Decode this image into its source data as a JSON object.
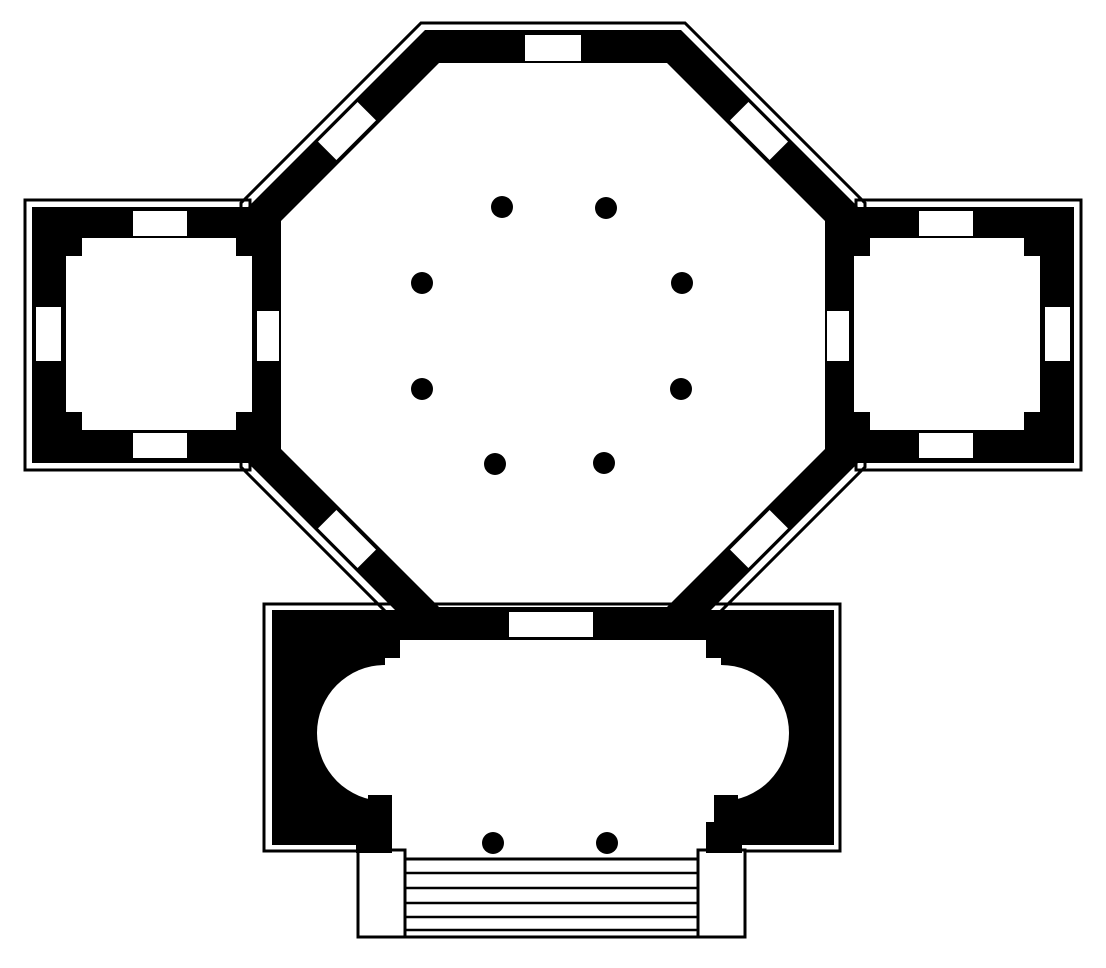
{
  "figure": {
    "kind": "architectural-floor-plan",
    "description": "Black-ink floor plan of an octagonal domed hall with an inner ring of eight columns, flanked by two square side chambers with wall niches, and a south vestibule containing an oval hall with apses at both ends, opening through two porch columns onto a flight of steps.",
    "inventory": {
      "rotunda_columns": 8,
      "porch_columns": 2,
      "step_treads": 6,
      "side_chambers": 2,
      "octagon_windows": 5,
      "chamber_niches_per_chamber": 3,
      "apses": 2
    }
  },
  "colors": {
    "ink": "#000000",
    "paper": "#ffffff",
    "none": "none"
  },
  "canvas": {
    "width": 1106,
    "height": 968
  },
  "shapes": [
    {
      "name": "octagon-outer-outline",
      "type": "polygon",
      "paint": {
        "fill": "none",
        "stroke": "ink",
        "sw": 3
      },
      "attrs": {
        "points": "421,23 685,23 865,203 865,467 685,647 421,647 241,467 241,203"
      }
    },
    {
      "name": "left-chamber-outline",
      "type": "rect",
      "paint": {
        "fill": "none",
        "stroke": "ink",
        "sw": 3
      },
      "attrs": {
        "x": 25,
        "y": 200,
        "width": 225,
        "height": 270
      }
    },
    {
      "name": "right-chamber-outline",
      "type": "rect",
      "paint": {
        "fill": "none",
        "stroke": "ink",
        "sw": 3
      },
      "attrs": {
        "x": 856,
        "y": 200,
        "width": 225,
        "height": 270
      }
    },
    {
      "name": "vestibule-outline",
      "type": "path",
      "paint": {
        "fill": "none",
        "stroke": "ink",
        "sw": 3
      },
      "attrs": {
        "d": "M 361 851 H 264 V 604 H 840 V 851 H 745"
      }
    },
    {
      "name": "octagon-wall-ring",
      "type": "path",
      "paint": {
        "fill": "ink",
        "stroke": "none",
        "sw": 0,
        "evenodd": true
      },
      "attrs": {
        "d": "M425,30 L681,30 L858,207 L858,463 L681,640 L425,640 L248,463 L248,207 Z M439,63 L667,63 L825,221 L825,449 L667,607 L439,607 L281,449 L281,221 Z"
      }
    },
    {
      "name": "left-chamber-walls",
      "type": "rect",
      "paint": {
        "fill": "ink",
        "stroke": "none",
        "sw": 0
      },
      "attrs": {
        "x": 32,
        "y": 207,
        "width": 249,
        "height": 256
      }
    },
    {
      "name": "right-chamber-walls",
      "type": "rect",
      "paint": {
        "fill": "ink",
        "stroke": "none",
        "sw": 0
      },
      "attrs": {
        "x": 825,
        "y": 207,
        "width": 249,
        "height": 256
      }
    },
    {
      "name": "vestibule-walls",
      "type": "rect",
      "paint": {
        "fill": "ink",
        "stroke": "none",
        "sw": 0
      },
      "attrs": {
        "x": 272,
        "y": 610,
        "width": 562,
        "height": 235
      }
    },
    {
      "name": "left-chamber-room",
      "type": "rect",
      "paint": {
        "fill": "paper",
        "stroke": "none",
        "sw": 0
      },
      "attrs": {
        "x": 66,
        "y": 238,
        "width": 186,
        "height": 192
      }
    },
    {
      "name": "right-chamber-room",
      "type": "rect",
      "paint": {
        "fill": "paper",
        "stroke": "none",
        "sw": 0
      },
      "attrs": {
        "x": 854,
        "y": 238,
        "width": 186,
        "height": 192
      }
    },
    {
      "name": "vestibule-hall-center",
      "type": "rect",
      "paint": {
        "fill": "paper",
        "stroke": "none",
        "sw": 0
      },
      "attrs": {
        "x": 385,
        "y": 658,
        "width": 336,
        "height": 187
      }
    },
    {
      "name": "vestibule-hall-top",
      "type": "rect",
      "paint": {
        "fill": "paper",
        "stroke": "none",
        "sw": 0
      },
      "attrs": {
        "x": 400,
        "y": 640,
        "width": 306,
        "height": 20
      }
    },
    {
      "name": "left-apse",
      "type": "circle",
      "paint": {
        "fill": "paper",
        "stroke": "none",
        "sw": 0
      },
      "attrs": {
        "cx": 385,
        "cy": 733,
        "r": 68
      }
    },
    {
      "name": "right-apse",
      "type": "circle",
      "paint": {
        "fill": "paper",
        "stroke": "none",
        "sw": 0
      },
      "attrs": {
        "cx": 721,
        "cy": 733,
        "r": 68
      }
    },
    {
      "name": "left-chamber-corner-pier-nw",
      "type": "rect",
      "paint": {
        "fill": "ink",
        "stroke": "none",
        "sw": 0
      },
      "attrs": {
        "x": 66,
        "y": 238,
        "width": 16,
        "height": 18
      }
    },
    {
      "name": "left-chamber-corner-pier-ne",
      "type": "rect",
      "paint": {
        "fill": "ink",
        "stroke": "none",
        "sw": 0
      },
      "attrs": {
        "x": 236,
        "y": 238,
        "width": 16,
        "height": 18
      }
    },
    {
      "name": "left-chamber-corner-pier-sw",
      "type": "rect",
      "paint": {
        "fill": "ink",
        "stroke": "none",
        "sw": 0
      },
      "attrs": {
        "x": 66,
        "y": 412,
        "width": 16,
        "height": 18
      }
    },
    {
      "name": "left-chamber-corner-pier-se",
      "type": "rect",
      "paint": {
        "fill": "ink",
        "stroke": "none",
        "sw": 0
      },
      "attrs": {
        "x": 236,
        "y": 412,
        "width": 16,
        "height": 18
      }
    },
    {
      "name": "right-chamber-corner-pier-nw",
      "type": "rect",
      "paint": {
        "fill": "ink",
        "stroke": "none",
        "sw": 0
      },
      "attrs": {
        "x": 854,
        "y": 238,
        "width": 16,
        "height": 18
      }
    },
    {
      "name": "right-chamber-corner-pier-ne",
      "type": "rect",
      "paint": {
        "fill": "ink",
        "stroke": "none",
        "sw": 0
      },
      "attrs": {
        "x": 1024,
        "y": 238,
        "width": 16,
        "height": 18
      }
    },
    {
      "name": "right-chamber-corner-pier-sw",
      "type": "rect",
      "paint": {
        "fill": "ink",
        "stroke": "none",
        "sw": 0
      },
      "attrs": {
        "x": 854,
        "y": 412,
        "width": 16,
        "height": 18
      }
    },
    {
      "name": "right-chamber-corner-pier-se",
      "type": "rect",
      "paint": {
        "fill": "ink",
        "stroke": "none",
        "sw": 0
      },
      "attrs": {
        "x": 1024,
        "y": 412,
        "width": 16,
        "height": 18
      }
    },
    {
      "name": "porch-wall-stub-left-upper",
      "type": "rect",
      "paint": {
        "fill": "ink",
        "stroke": "none",
        "sw": 0
      },
      "attrs": {
        "x": 368,
        "y": 795,
        "width": 24,
        "height": 31
      }
    },
    {
      "name": "porch-wall-stub-left-lower",
      "type": "rect",
      "paint": {
        "fill": "ink",
        "stroke": "none",
        "sw": 0
      },
      "attrs": {
        "x": 356,
        "y": 822,
        "width": 36,
        "height": 31
      }
    },
    {
      "name": "porch-wall-stub-right-upper",
      "type": "rect",
      "paint": {
        "fill": "ink",
        "stroke": "none",
        "sw": 0
      },
      "attrs": {
        "x": 714,
        "y": 795,
        "width": 24,
        "height": 31
      }
    },
    {
      "name": "porch-wall-stub-right-lower",
      "type": "rect",
      "paint": {
        "fill": "ink",
        "stroke": "none",
        "sw": 0
      },
      "attrs": {
        "x": 706,
        "y": 822,
        "width": 36,
        "height": 31
      }
    },
    {
      "name": "octagon-window-north",
      "type": "rect",
      "paint": {
        "fill": "paper",
        "stroke": "none",
        "sw": 0
      },
      "attrs": {
        "x": 525,
        "y": 35,
        "width": 56,
        "height": 26
      }
    },
    {
      "name": "octagon-window-northwest",
      "type": "rect",
      "paint": {
        "fill": "paper",
        "stroke": "none",
        "sw": 0
      },
      "attrs": {
        "x": 319,
        "y": 118,
        "width": 56,
        "height": 26,
        "transform": "rotate(-45 347 131)"
      }
    },
    {
      "name": "octagon-window-northeast",
      "type": "rect",
      "paint": {
        "fill": "paper",
        "stroke": "none",
        "sw": 0
      },
      "attrs": {
        "x": 731,
        "y": 118,
        "width": 56,
        "height": 26,
        "transform": "rotate(45 759 131)"
      }
    },
    {
      "name": "octagon-window-southwest",
      "type": "rect",
      "paint": {
        "fill": "paper",
        "stroke": "none",
        "sw": 0
      },
      "attrs": {
        "x": 319,
        "y": 526,
        "width": 56,
        "height": 26,
        "transform": "rotate(45 347 539)"
      }
    },
    {
      "name": "octagon-window-southeast",
      "type": "rect",
      "paint": {
        "fill": "paper",
        "stroke": "none",
        "sw": 0
      },
      "attrs": {
        "x": 731,
        "y": 526,
        "width": 56,
        "height": 26,
        "transform": "rotate(-45 759 539)"
      }
    },
    {
      "name": "octagon-south-doorway",
      "type": "rect",
      "paint": {
        "fill": "paper",
        "stroke": "none",
        "sw": 0
      },
      "attrs": {
        "x": 509,
        "y": 612,
        "width": 84,
        "height": 25
      }
    },
    {
      "name": "left-chamber-niche-north",
      "type": "rect",
      "paint": {
        "fill": "paper",
        "stroke": "none",
        "sw": 0
      },
      "attrs": {
        "x": 133,
        "y": 211,
        "width": 54,
        "height": 25
      }
    },
    {
      "name": "left-chamber-niche-south",
      "type": "rect",
      "paint": {
        "fill": "paper",
        "stroke": "none",
        "sw": 0
      },
      "attrs": {
        "x": 133,
        "y": 433,
        "width": 54,
        "height": 25
      }
    },
    {
      "name": "left-chamber-niche-west",
      "type": "rect",
      "paint": {
        "fill": "paper",
        "stroke": "none",
        "sw": 0
      },
      "attrs": {
        "x": 36,
        "y": 307,
        "width": 25,
        "height": 54
      }
    },
    {
      "name": "left-chamber-doorway",
      "type": "rect",
      "paint": {
        "fill": "paper",
        "stroke": "none",
        "sw": 0
      },
      "attrs": {
        "x": 257,
        "y": 311,
        "width": 22,
        "height": 50
      }
    },
    {
      "name": "right-chamber-niche-north",
      "type": "rect",
      "paint": {
        "fill": "paper",
        "stroke": "none",
        "sw": 0
      },
      "attrs": {
        "x": 919,
        "y": 211,
        "width": 54,
        "height": 25
      }
    },
    {
      "name": "right-chamber-niche-south",
      "type": "rect",
      "paint": {
        "fill": "paper",
        "stroke": "none",
        "sw": 0
      },
      "attrs": {
        "x": 919,
        "y": 433,
        "width": 54,
        "height": 25
      }
    },
    {
      "name": "right-chamber-niche-east",
      "type": "rect",
      "paint": {
        "fill": "paper",
        "stroke": "none",
        "sw": 0
      },
      "attrs": {
        "x": 1045,
        "y": 307,
        "width": 25,
        "height": 54
      }
    },
    {
      "name": "right-chamber-doorway",
      "type": "rect",
      "paint": {
        "fill": "paper",
        "stroke": "none",
        "sw": 0
      },
      "attrs": {
        "x": 827,
        "y": 311,
        "width": 22,
        "height": 50
      }
    },
    {
      "name": "porch-pier-left",
      "type": "rect",
      "paint": {
        "fill": "none",
        "stroke": "ink",
        "sw": 3
      },
      "attrs": {
        "x": 358,
        "y": 850,
        "width": 47,
        "height": 87
      }
    },
    {
      "name": "porch-pier-right",
      "type": "rect",
      "paint": {
        "fill": "none",
        "stroke": "ink",
        "sw": 3
      },
      "attrs": {
        "x": 698,
        "y": 850,
        "width": 47,
        "height": 87
      }
    },
    {
      "name": "steps-outline",
      "type": "rect",
      "paint": {
        "fill": "paper",
        "stroke": "ink",
        "sw": 3
      },
      "attrs": {
        "x": 405,
        "y": 859,
        "width": 293,
        "height": 78
      }
    },
    {
      "name": "step-line-1",
      "type": "line",
      "paint": {
        "fill": "none",
        "stroke": "ink",
        "sw": 2.5
      },
      "attrs": {
        "x1": 405,
        "y1": 873,
        "x2": 698,
        "y2": 873
      }
    },
    {
      "name": "step-line-2",
      "type": "line",
      "paint": {
        "fill": "none",
        "stroke": "ink",
        "sw": 2.5
      },
      "attrs": {
        "x1": 405,
        "y1": 888,
        "x2": 698,
        "y2": 888
      }
    },
    {
      "name": "step-line-3",
      "type": "line",
      "paint": {
        "fill": "none",
        "stroke": "ink",
        "sw": 2.5
      },
      "attrs": {
        "x1": 405,
        "y1": 903,
        "x2": 698,
        "y2": 903
      }
    },
    {
      "name": "step-line-4",
      "type": "line",
      "paint": {
        "fill": "none",
        "stroke": "ink",
        "sw": 2.5
      },
      "attrs": {
        "x1": 405,
        "y1": 917,
        "x2": 698,
        "y2": 917
      }
    },
    {
      "name": "step-line-5",
      "type": "line",
      "paint": {
        "fill": "none",
        "stroke": "ink",
        "sw": 2.5
      },
      "attrs": {
        "x1": 405,
        "y1": 930,
        "x2": 698,
        "y2": 930
      }
    },
    {
      "name": "rotunda-column-1",
      "type": "circle",
      "paint": {
        "fill": "ink",
        "stroke": "none",
        "sw": 0
      },
      "attrs": {
        "cx": 502,
        "cy": 207,
        "r": 11
      }
    },
    {
      "name": "rotunda-column-2",
      "type": "circle",
      "paint": {
        "fill": "ink",
        "stroke": "none",
        "sw": 0
      },
      "attrs": {
        "cx": 606,
        "cy": 208,
        "r": 11
      }
    },
    {
      "name": "rotunda-column-3",
      "type": "circle",
      "paint": {
        "fill": "ink",
        "stroke": "none",
        "sw": 0
      },
      "attrs": {
        "cx": 422,
        "cy": 283,
        "r": 11
      }
    },
    {
      "name": "rotunda-column-4",
      "type": "circle",
      "paint": {
        "fill": "ink",
        "stroke": "none",
        "sw": 0
      },
      "attrs": {
        "cx": 682,
        "cy": 283,
        "r": 11
      }
    },
    {
      "name": "rotunda-column-5",
      "type": "circle",
      "paint": {
        "fill": "ink",
        "stroke": "none",
        "sw": 0
      },
      "attrs": {
        "cx": 422,
        "cy": 389,
        "r": 11
      }
    },
    {
      "name": "rotunda-column-6",
      "type": "circle",
      "paint": {
        "fill": "ink",
        "stroke": "none",
        "sw": 0
      },
      "attrs": {
        "cx": 681,
        "cy": 389,
        "r": 11
      }
    },
    {
      "name": "rotunda-column-7",
      "type": "circle",
      "paint": {
        "fill": "ink",
        "stroke": "none",
        "sw": 0
      },
      "attrs": {
        "cx": 495,
        "cy": 464,
        "r": 11
      }
    },
    {
      "name": "rotunda-column-8",
      "type": "circle",
      "paint": {
        "fill": "ink",
        "stroke": "none",
        "sw": 0
      },
      "attrs": {
        "cx": 604,
        "cy": 463,
        "r": 11
      }
    },
    {
      "name": "porch-column-left",
      "type": "circle",
      "paint": {
        "fill": "ink",
        "stroke": "none",
        "sw": 0
      },
      "attrs": {
        "cx": 493,
        "cy": 843,
        "r": 11
      }
    },
    {
      "name": "porch-column-right",
      "type": "circle",
      "paint": {
        "fill": "ink",
        "stroke": "none",
        "sw": 0
      },
      "attrs": {
        "cx": 607,
        "cy": 843,
        "r": 11
      }
    }
  ]
}
